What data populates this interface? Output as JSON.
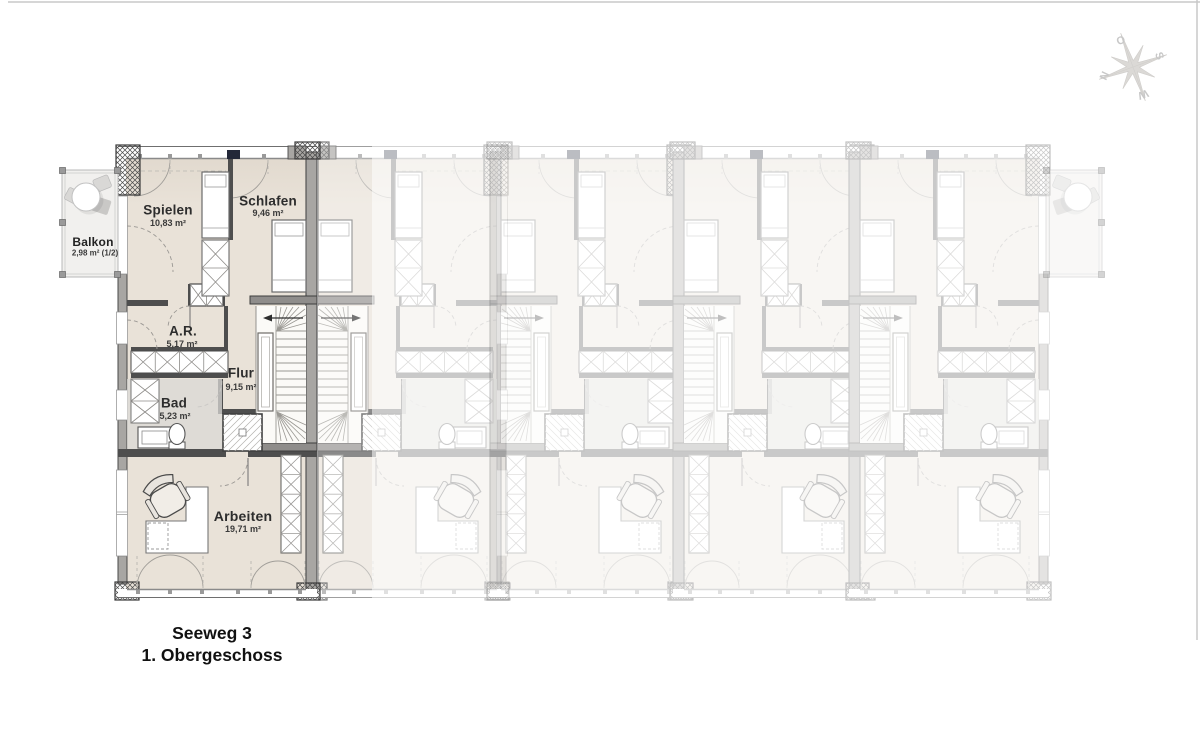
{
  "drawing": {
    "title_line1": "Seeweg 3",
    "title_line2": "1. Obergeschoss"
  },
  "compass": {
    "north": "N",
    "east": "O",
    "south": "S",
    "west": "W"
  },
  "rooms": [
    {
      "id": "balkon",
      "name": "Balkon",
      "area": "2,98 m² (1/2)"
    },
    {
      "id": "spielen",
      "name": "Spielen",
      "area": "10,83 m²"
    },
    {
      "id": "schlafen",
      "name": "Schlafen",
      "area": "9,46 m²"
    },
    {
      "id": "ar",
      "name": "A.R.",
      "area": "5,17 m²"
    },
    {
      "id": "flur",
      "name": "Flur",
      "area": "9,15 m²"
    },
    {
      "id": "bad",
      "name": "Bad",
      "area": "5,23 m²"
    },
    {
      "id": "arbeiten",
      "name": "Arbeiten",
      "area": "19,71 m²"
    }
  ],
  "colors": {
    "highlight_floor": "#e9e2d8",
    "wall_dark": "#4a4a4a",
    "wall_fill": "#a8a6a3",
    "ghost_tint": "#f6f3ef",
    "bath_floor": "#dad8d5"
  }
}
